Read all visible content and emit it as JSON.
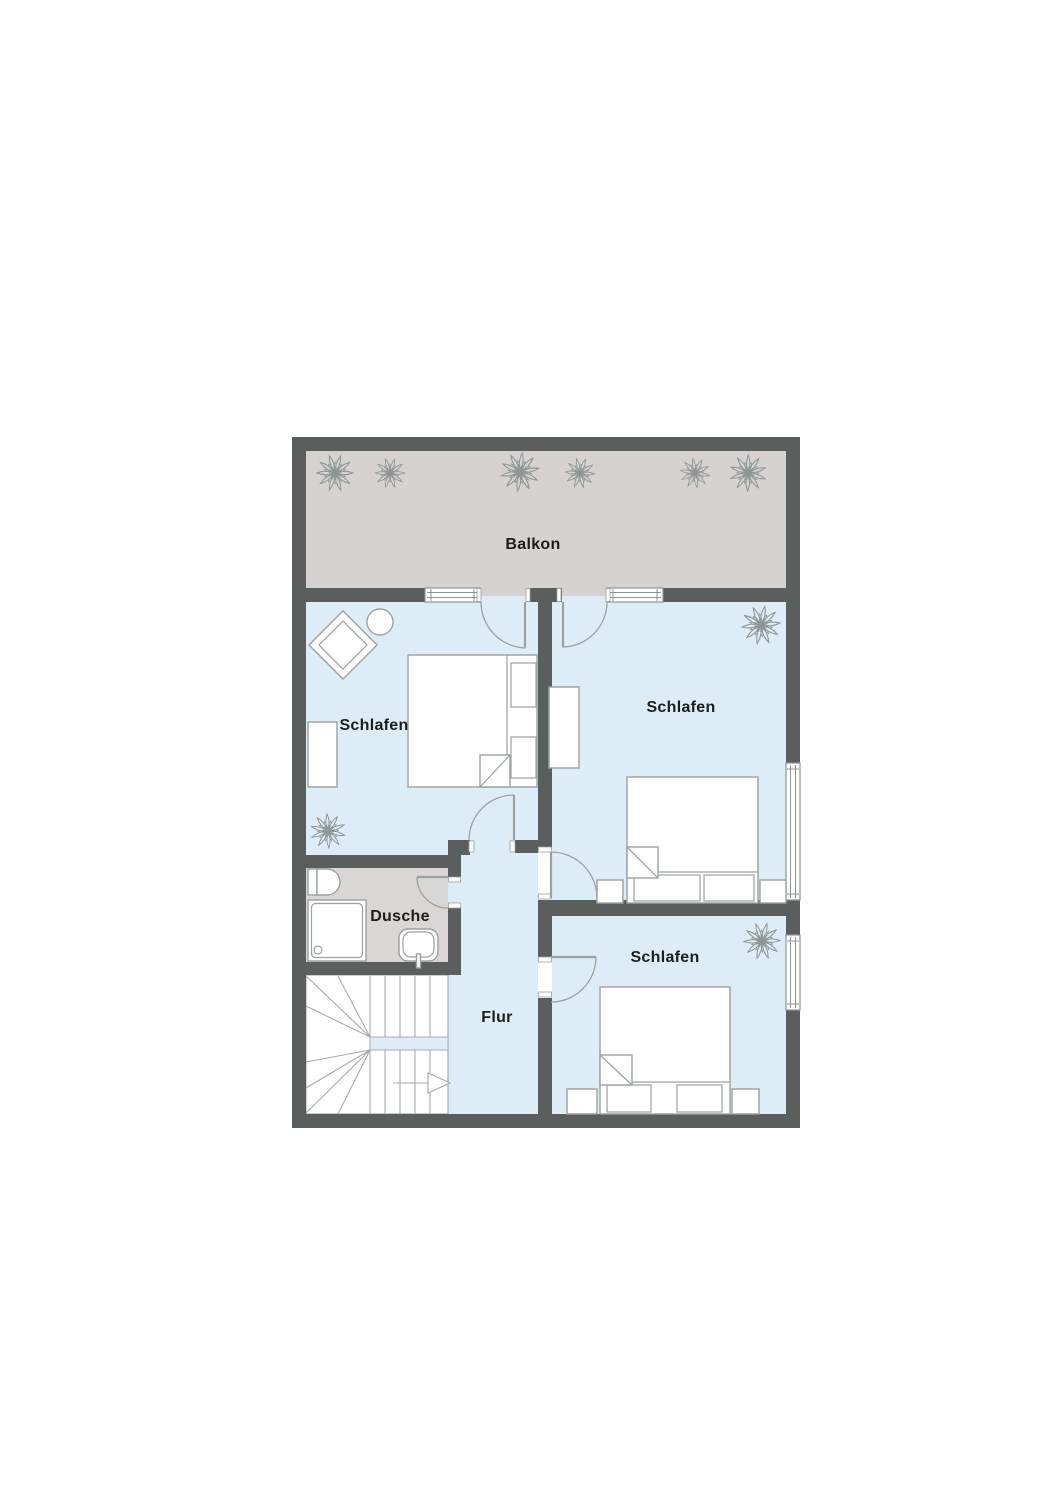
{
  "rooms": {
    "balcony": {
      "label": "Balkon"
    },
    "bedroom_left": {
      "label": "Schlafen"
    },
    "bedroom_top_right": {
      "label": "Schlafen"
    },
    "bedroom_bottom_right": {
      "label": "Schlafen"
    },
    "shower": {
      "label": "Dusche"
    },
    "hallway": {
      "label": "Flur"
    }
  },
  "icons": [
    "plant-icon",
    "toilet-icon",
    "shower-tray-icon",
    "sink-icon",
    "double-bed-icon",
    "single-pillow-icon",
    "wardrobe-icon",
    "armchair-icon",
    "side-table-icon",
    "stairs-icon",
    "door-swing-icon",
    "window-icon",
    "direction-arrow-icon"
  ],
  "colors": {
    "wall": "#5a5f5e",
    "room-floor": "#ddedf8",
    "outdoor-floor": "#d5d2d1",
    "shower-floor": "#d9d6d5",
    "furniture-line": "#9aa19e",
    "label-text": "#1d1d1b",
    "page-bg": "#ffffff"
  }
}
